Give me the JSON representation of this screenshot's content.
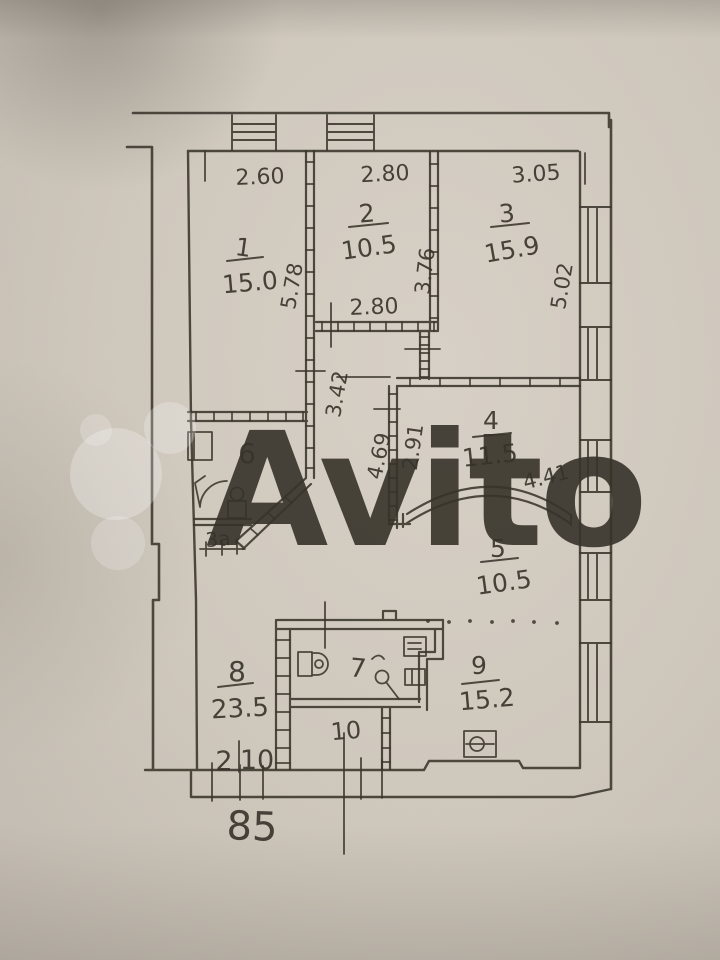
{
  "colors": {
    "paper": "#cfc8bd",
    "ink": "#3a362c",
    "watermark": "#ffffff"
  },
  "watermark": {
    "text": "Avito"
  },
  "rooms": {
    "r1": {
      "number": "1",
      "area": "15.0"
    },
    "r2": {
      "number": "2",
      "area": "10.5"
    },
    "r3": {
      "number": "3",
      "area": "15.9"
    },
    "r4": {
      "number": "4",
      "area": "11.5"
    },
    "r5": {
      "number": "5",
      "area": "10.5"
    },
    "r6": {
      "number": "6"
    },
    "r7": {
      "number": "7"
    },
    "r8": {
      "number": "8",
      "area": "23.5"
    },
    "r9": {
      "number": "9",
      "area": "15.2"
    },
    "r10": {
      "number": "10"
    }
  },
  "dimensions": {
    "room1_width": "2.60",
    "room2_width": "2.80",
    "room3_width": "3.05",
    "room1_depth": "5.78",
    "room2_depth": "3.76",
    "room3_depth": "5.02",
    "room2_width_bottom": "2.80",
    "corridor_width": "3.42",
    "hall_depth": "4.69",
    "room4_wall": "2.91",
    "room4_width": "4.41"
  },
  "annotations": {
    "room6_sub": "3а",
    "floor_current": "2",
    "floor_total": "10",
    "bottom_number": "85"
  }
}
